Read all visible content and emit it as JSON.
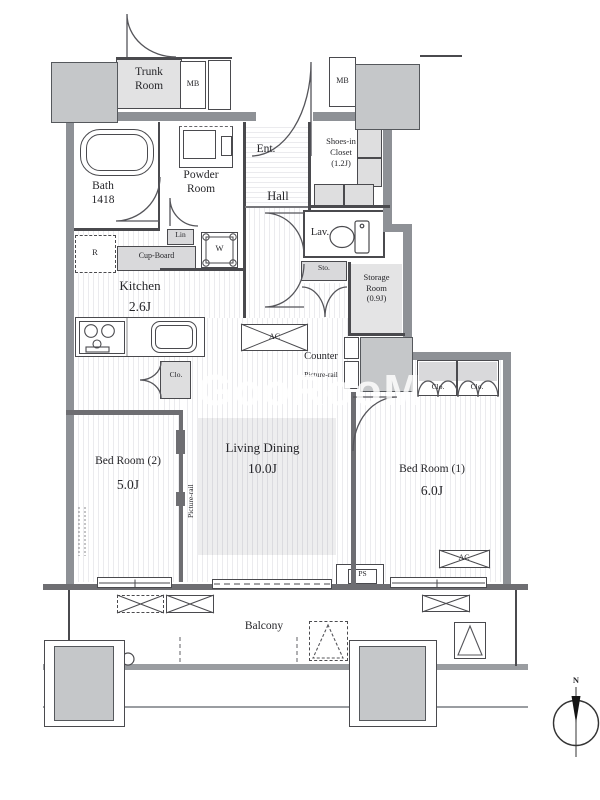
{
  "colors": {
    "wall": "#8e9196",
    "wall_dark": "#6e6e72",
    "partition_line": "#4a4a4e",
    "pillar": "#c5c7c9",
    "floor_stripe": "#ebebee",
    "watermark": "#ffffff"
  },
  "watermark": {
    "text": "GooRooM"
  },
  "compass": {
    "north": "N"
  },
  "rooms": {
    "trunk": {
      "line1": "Trunk",
      "line2": "Room"
    },
    "mb_left": {
      "label": "MB"
    },
    "mb_right": {
      "label": "MB"
    },
    "bath": {
      "name": "Bath",
      "size": "1418"
    },
    "powder": {
      "line1": "Powder",
      "line2": "Room"
    },
    "ent": {
      "name": "Ent."
    },
    "shoes": {
      "line1": "Shoes-in",
      "line2": "Closet",
      "line3": "(1.2J)"
    },
    "hall": {
      "name": "Hall"
    },
    "lav": {
      "name": "Lav."
    },
    "storage": {
      "line1": "Storage",
      "line2": "Room",
      "line3": "(0.9J)"
    },
    "kitchen": {
      "name": "Kitchen",
      "size": "2.6J"
    },
    "living": {
      "name": "Living Dining",
      "size": "10.0J"
    },
    "bedroom2": {
      "name": "Bed Room (2)",
      "size": "5.0J"
    },
    "bedroom1": {
      "name": "Bed Room (1)",
      "size": "6.0J"
    },
    "balcony": {
      "name": "Balcony"
    }
  },
  "fixtures": {
    "lin": "Lin",
    "washer": "W",
    "fridge": "R",
    "cupboard": "Cup-Board",
    "sto": "Sto.",
    "closet_kitchen": "Clo.",
    "closet_b1_left": "Clo.",
    "closet_b1_right": "Clo.",
    "ac_living": "AC",
    "ac_bedroom1": "AC",
    "ps": "PS",
    "counter": "Counter",
    "picture_rail_living": "Picture-rail",
    "picture_rail_bedroom2": "Picture-rail"
  }
}
